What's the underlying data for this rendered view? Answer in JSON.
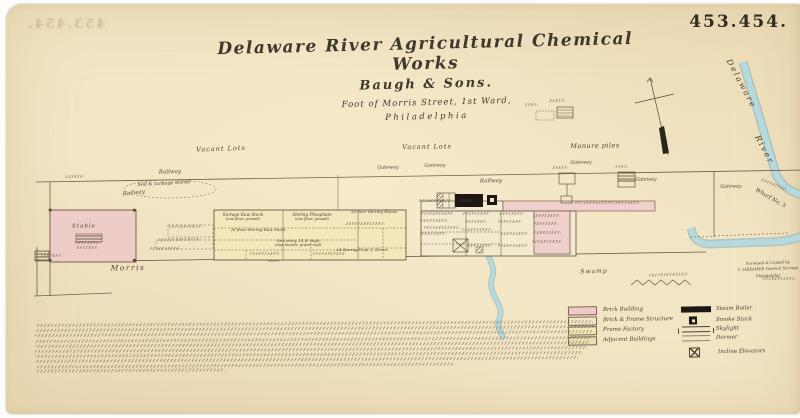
{
  "sheet": {
    "number": "453.454.",
    "bleedthrough": "453.454."
  },
  "title": {
    "line1": "Delaware River Agricultural Chemical Works",
    "line2": "Baugh & Sons.",
    "line3": "Foot of Morris Street, 1st Ward,",
    "line4": "Philadelphia"
  },
  "colors": {
    "paper": "#f2e5c3",
    "ink": "#3e382e",
    "map_line": "#6e5f4b",
    "brick_pink": "#eeccc8",
    "frame_yellow": "#f1e8bc",
    "river_blue": "#b6d9de",
    "boiler_black": "#1d1813"
  },
  "map": {
    "labels": [
      {
        "text": "Vacant Lots",
        "x": 221,
        "y": 149,
        "size": 6.5,
        "rot": -2,
        "ls": 1
      },
      {
        "text": "Vacant Lots",
        "x": 427,
        "y": 147,
        "size": 6.5,
        "rot": -1,
        "ls": 1
      },
      {
        "text": "Manure piles",
        "x": 595,
        "y": 146,
        "size": 6.5,
        "rot": -1,
        "ls": 0.5
      },
      {
        "text": "Railway",
        "x": 170,
        "y": 173,
        "size": 5.5,
        "rot": -2,
        "ls": 0
      },
      {
        "text": "Soil & turbage stored",
        "x": 164,
        "y": 185,
        "size": 4.8,
        "rot": -3,
        "ls": 0
      },
      {
        "text": "Railway",
        "x": 134,
        "y": 194,
        "size": 5.5,
        "rot": -6,
        "ls": 0
      },
      {
        "text": "Gateway",
        "x": 388,
        "y": 169,
        "size": 4.8,
        "rot": -1,
        "ls": 0
      },
      {
        "text": "Gateway",
        "x": 435,
        "y": 167,
        "size": 4.8,
        "rot": -1,
        "ls": 0
      },
      {
        "text": "Railway",
        "x": 491,
        "y": 182,
        "size": 5.5,
        "rot": -1,
        "ls": 0
      },
      {
        "text": "Gateway",
        "x": 581,
        "y": 164,
        "size": 4.8,
        "rot": -1,
        "ls": 0
      },
      {
        "text": "Gateway",
        "x": 646,
        "y": 181,
        "size": 4.8,
        "rot": -1,
        "ls": 0
      },
      {
        "text": "Gateway",
        "x": 731,
        "y": 188,
        "size": 4.8,
        "rot": -1,
        "ls": 0
      },
      {
        "text": "Morris",
        "x": 128,
        "y": 268,
        "size": 7.5,
        "rot": -1,
        "ls": 1.5
      },
      {
        "text": "Swamp",
        "x": 594,
        "y": 272,
        "size": 6,
        "rot": -2,
        "ls": 1
      },
      {
        "text": "Delaware",
        "x": 741,
        "y": 84,
        "size": 8,
        "rot": 62,
        "ls": 2
      },
      {
        "text": "River",
        "x": 764,
        "y": 150,
        "size": 8,
        "rot": 62,
        "ls": 2
      },
      {
        "text": "Wharf No. 5",
        "x": 770,
        "y": 199,
        "size": 5.5,
        "rot": 30,
        "ls": 0
      },
      {
        "text": "Stable",
        "x": 84,
        "y": 227,
        "size": 5.5,
        "rot": 0,
        "ls": 1
      },
      {
        "text": "Storage Raw Stock",
        "x": 243,
        "y": 215,
        "size": 4.2,
        "rot": 0,
        "ls": 0
      },
      {
        "text": "(one floor, ground)",
        "x": 243,
        "y": 220,
        "size": 3.6,
        "rot": 0,
        "ls": 0
      },
      {
        "text": "Storing Phosphate",
        "x": 312,
        "y": 215,
        "size": 4.2,
        "rot": 0,
        "ls": 0
      },
      {
        "text": "(one floor, ground)",
        "x": 312,
        "y": 220,
        "size": 3.6,
        "rot": 0,
        "ls": 0
      },
      {
        "text": "2d floor Storing House",
        "x": 374,
        "y": 212,
        "size": 4,
        "rot": 0,
        "ls": 0
      },
      {
        "text": "2d floor Storing Raw Stock",
        "x": 258,
        "y": 230,
        "size": 4,
        "rot": 0,
        "ls": 0
      },
      {
        "text": "One story, 14 ft. high",
        "x": 298,
        "y": 241,
        "size": 4,
        "rot": 0,
        "ls": 0
      },
      {
        "text": "(clap boards, gravel roof)",
        "x": 298,
        "y": 246,
        "size": 3.6,
        "rot": 0,
        "ls": 0
      },
      {
        "text": "2d Storing Dept & Stores",
        "x": 362,
        "y": 250,
        "size": 4,
        "rot": 0,
        "ls": 0
      }
    ],
    "illegible_marks": [
      [
        64,
        175,
        20,
        -2
      ],
      [
        524,
        103,
        14,
        -2
      ],
      [
        549,
        99,
        16,
        -2
      ],
      [
        168,
        225,
        34,
        -1
      ],
      [
        158,
        238,
        42,
        -1
      ],
      [
        150,
        247,
        30,
        -1
      ],
      [
        74,
        241,
        26,
        0
      ],
      [
        76,
        246,
        22,
        0
      ],
      [
        40,
        254,
        22,
        -1
      ],
      [
        552,
        166,
        16,
        -2
      ],
      [
        614,
        165,
        14,
        -2
      ],
      [
        418,
        199,
        34,
        0
      ],
      [
        458,
        199,
        16,
        0
      ],
      [
        420,
        212,
        34,
        0
      ],
      [
        420,
        219,
        28,
        0
      ],
      [
        424,
        226,
        36,
        0
      ],
      [
        420,
        232,
        26,
        0
      ],
      [
        462,
        212,
        28,
        0
      ],
      [
        465,
        220,
        22,
        0
      ],
      [
        462,
        228,
        30,
        0
      ],
      [
        498,
        212,
        26,
        0
      ],
      [
        498,
        220,
        24,
        0
      ],
      [
        500,
        232,
        28,
        0
      ],
      [
        466,
        244,
        26,
        0
      ],
      [
        498,
        244,
        30,
        0
      ],
      [
        532,
        214,
        28,
        0
      ],
      [
        534,
        222,
        24,
        0
      ],
      [
        533,
        231,
        28,
        0
      ],
      [
        532,
        240,
        30,
        0
      ],
      [
        575,
        201,
        36,
        0
      ],
      [
        610,
        201,
        30,
        0
      ],
      [
        250,
        252,
        30,
        0
      ],
      [
        312,
        252,
        34,
        0
      ],
      [
        345,
        222,
        40,
        0
      ],
      [
        648,
        273,
        40,
        -2
      ],
      [
        760,
        183,
        28,
        22
      ],
      [
        762,
        277,
        34,
        0
      ]
    ]
  },
  "legend": {
    "building_types": [
      {
        "label": "Brick Building",
        "color": "#eccac5"
      },
      {
        "label": "Brick & Frame Structure",
        "color": "#f4e5ca"
      },
      {
        "label": "Frame Factory",
        "color": "#f2e8ba"
      },
      {
        "label": "Adjacent Buildings",
        "color": "#e9dcb0"
      }
    ],
    "symbols": [
      {
        "label": "Steam Boiler",
        "symbol": "steam-boiler",
        "dy": 0
      },
      {
        "label": "Smoke Stack",
        "symbol": "smoke-stack",
        "dy": 10
      },
      {
        "label": "Skylight",
        "symbol": "skylight",
        "dy": 20
      },
      {
        "label": "Dormer",
        "symbol": "dormer",
        "dy": 29
      },
      {
        "label": "Incline Elevators",
        "symbol": "incline",
        "dy": 41
      }
    ]
  },
  "imprint": {
    "lines": [
      "Surveyed & Copied by",
      "C. HEXAMER  General Surveys",
      "Philadelphia"
    ]
  },
  "notes": {
    "x": 35,
    "y": 322,
    "step": 5.2,
    "line_widths": [
      558,
      561,
      559,
      557,
      555,
      552,
      548,
      543,
      420,
      190
    ]
  }
}
